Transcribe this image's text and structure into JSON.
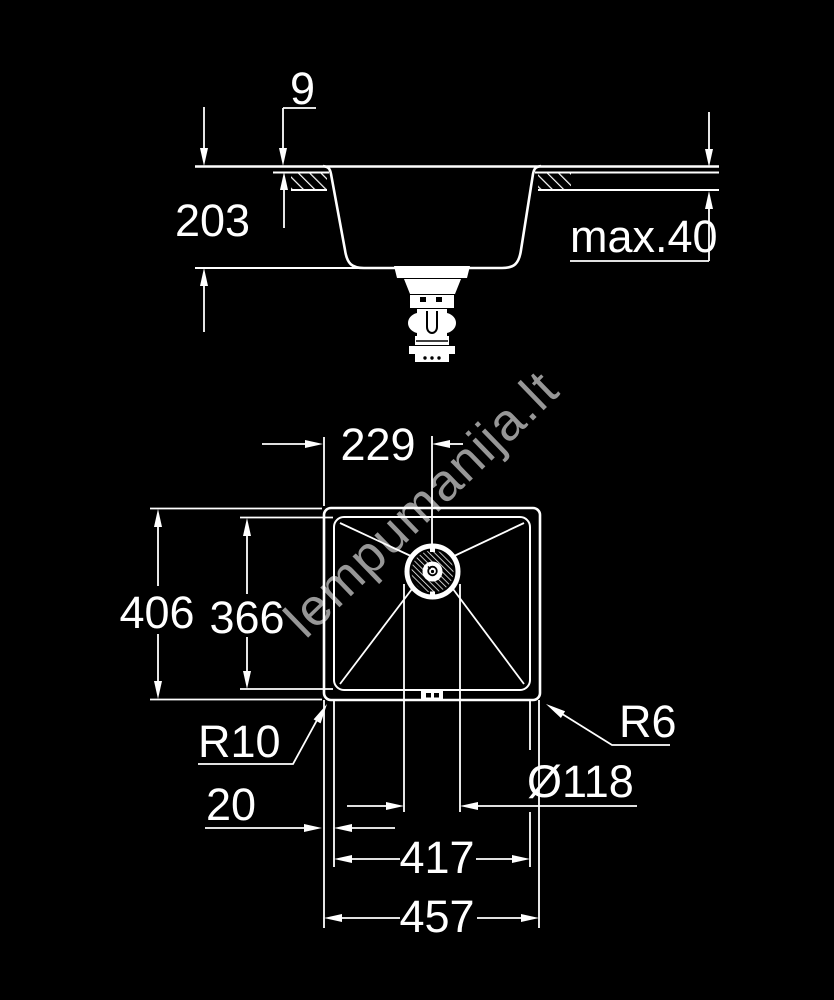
{
  "drawing": {
    "title": "sink-technical-dimension-drawing",
    "colors": {
      "background": "#000000",
      "line": "#ffffff",
      "watermark": "#979797"
    },
    "watermark": {
      "text": "lempumanija.lt"
    },
    "side_view": {
      "dims": {
        "rim_thickness": "9",
        "bowl_depth": "203",
        "counter_max_thickness": "max.40"
      }
    },
    "plan_view": {
      "dims": {
        "drain_offset": "229",
        "outer_height": "406",
        "inner_height": "366",
        "corner_radius_left": "R10",
        "corner_radius_right": "R6",
        "edge_gap": "20",
        "drain_diameter": "Ø118",
        "inner_width": "417",
        "outer_width": "457"
      }
    }
  }
}
